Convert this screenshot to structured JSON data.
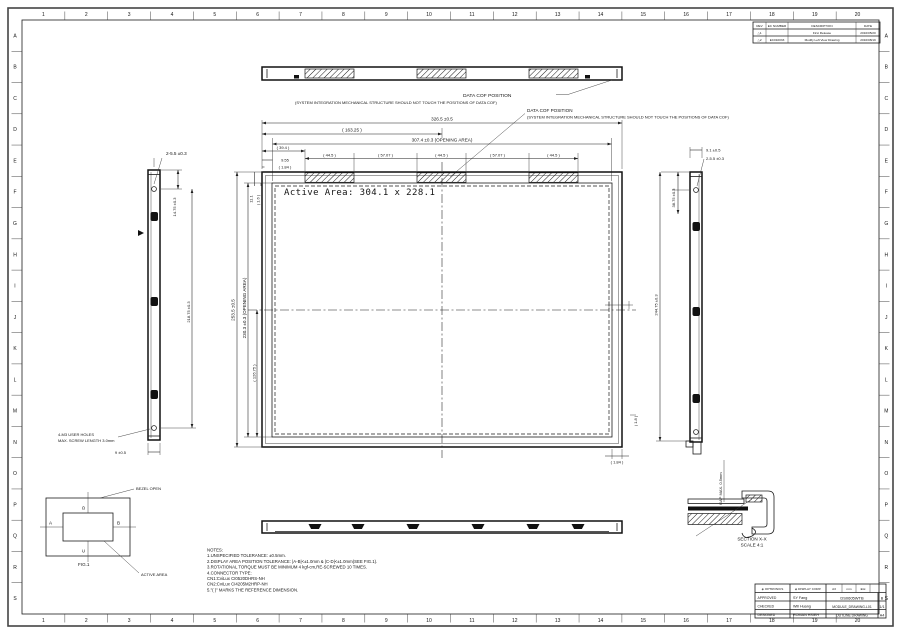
{
  "sheet": {
    "cols": [
      "1",
      "2",
      "3",
      "4",
      "5",
      "6",
      "7",
      "8",
      "9",
      "10",
      "11",
      "12",
      "13",
      "14",
      "15",
      "16",
      "17",
      "18",
      "19",
      "20"
    ],
    "rows": [
      "A",
      "B",
      "C",
      "D",
      "E",
      "F",
      "G",
      "H",
      "I",
      "J",
      "K",
      "L",
      "M",
      "N",
      "O",
      "P",
      "Q",
      "R",
      "S"
    ]
  },
  "revision_table": {
    "headers": {
      "rev": "REV",
      "ec": "EC NUMBER",
      "desc": "DESCRIPTION",
      "date": "DATE"
    },
    "rows": [
      {
        "rev": "△1",
        "ec": "",
        "desc": "First Release",
        "date": "2016/05/20"
      },
      {
        "rev": "△2",
        "ec": "EC010033",
        "desc": "Modify Left View Drawing",
        "date": "2016/08/19"
      }
    ]
  },
  "callouts": {
    "data_cof_top": {
      "line1": "DATA COF POSITION",
      "line2": "(SYSTEM INTEGRATION MECHANICAL STRUCTURE SHOULD NOT TOUCH THE POSITIONS OF DATA COF)"
    },
    "data_cof_front": {
      "line1": "DATA COF POSITION",
      "line2": "(SYSTEM INTEGRATION MECHANICAL STRUCTURE SHOULD NOT TOUCH THE POSITIONS OF DATA COF)"
    },
    "user_holes_1": "4-M3 USER HOLES",
    "user_holes_2": "MAX. SCREW LENGTH 3.0mm",
    "bezel_open": "BEZEL OPEN",
    "active_area": "ACTIVE AREA",
    "gap_max": "GAP MAX. 0.5mm"
  },
  "front_view": {
    "active_area_label": "Active Area: 304.1 x 228.1"
  },
  "dims": {
    "overall_w": "326.5 ±0.5",
    "half_w": "( 163.25 )",
    "opening_w": "307.4 ±0.3  (OPENING AREA)",
    "cof_offset": "( 39.4 )",
    "edge_offset": "9.55",
    "edge_ref": "( 1.84 )",
    "seg_a": "( 44.5 )",
    "seg_b": "( 57.07 )",
    "seg_c": "( 44.5 )",
    "seg_d": "( 57.07 )",
    "seg_e": "( 44.5 )",
    "overall_h": "253.5 ±0.5",
    "opening_h": "230.3 ±0.3 (OPENING AREA)",
    "half_h": "( 126.75 )",
    "top_gap": "11.1",
    "top_ref": "( 1.6 )",
    "bottom_ref": "( 1.84 )",
    "right_ref": "( 1.8 )",
    "left_holes": "2-5.5 ±0.3",
    "left_hole_top": "14.75 ±0.3",
    "left_hole_span": "218.75 ±0.3",
    "left_thickness": "9 ±0.5",
    "right_thickness": "9.1 ±0.5",
    "right_holes": "2-5.5 ±0.3",
    "right_hole_top": "38.75 ±0.3",
    "right_hole_span": "244.75 ±0.3"
  },
  "fig1": {
    "a": "A",
    "b": "B",
    "c": "C",
    "d": "D",
    "label": "FIG.1"
  },
  "section": {
    "title": "SECTION  X-X",
    "scale": "SCALE   4:1"
  },
  "notes": [
    "NOTES:",
    "1.UNSPECIFIED TOLERANCE:   ±0.5mm.",
    "2.DISPLAY AREA POSITION TOLERANCE: |A-B|<±1.0mm & |C-D|<±1.0mm(SEE FIG.1).",
    "3.ROTATIONAL TORQUE MUST BE MINIMUM 4 kgf-cm,RE-SCREWED 10 TIMES.",
    "4.CONNECTOR TYPE:",
    "    CN1:CviLux CI0520DHRS-NH",
    "    CN2:CviLux CI4205M2HRP-NH",
    "5.\"( )\" MARKS THE REFERENCE DIMENSION."
  ],
  "title_block": {
    "logo1": "◈ OPTRONICS",
    "logo2": "◈ DISPLAY CORP.",
    "size": "A3",
    "unit": "mm",
    "proj": "⊕⊖",
    "approved_label": "APPROVED",
    "approved": "SY Fang",
    "checked_label": "CHECKED",
    "checked": "Will Huang",
    "designed_label": "DESIGNED",
    "designed": "ROMAN HSIEH",
    "model_no": "DS0605WTB",
    "rev": "B",
    "doc_no": "MODULE_DRAWING-L01",
    "sheet": "1/1",
    "title": "OUTLINE DRAWING",
    "size2": "A4"
  },
  "colors": {
    "line": "#1c1c1c",
    "bg": "#ffffff"
  }
}
